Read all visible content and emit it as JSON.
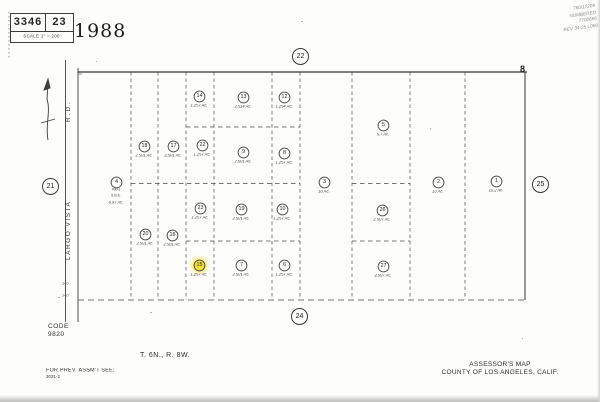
{
  "header": {
    "book": "3346",
    "page": "23",
    "scale_label": "SCALE 1\" =  200'",
    "year": "1988",
    "handwritten_notes": [
      "760/17209",
      "NUMBERED",
      "7702666",
      "REV 34-25 L068"
    ],
    "corner_point": "8"
  },
  "road": {
    "suffix": "R.D.",
    "name": "LARGO  VISTA",
    "width_label": "30",
    "station_labels": [
      "140",
      "140"
    ]
  },
  "boundary_circles": [
    {
      "label": "21",
      "x": 50,
      "y": 186
    },
    {
      "label": "22",
      "x": 300,
      "y": 56
    },
    {
      "label": "24",
      "x": 299,
      "y": 316
    },
    {
      "label": "25",
      "x": 540,
      "y": 184
    }
  ],
  "parcels": [
    {
      "num": "14",
      "acreage": "1.257 Ac.",
      "x": 199,
      "y": 96
    },
    {
      "num": "13",
      "acreage": "2.514 Ac.",
      "x": 243,
      "y": 97
    },
    {
      "num": "12",
      "acreage": "1.254 Ac.",
      "x": 284,
      "y": 97
    },
    {
      "num": "5",
      "acreage": "5.7 Ac.",
      "x": 383,
      "y": 125
    },
    {
      "num": "18",
      "acreage": "2.501 Ac.",
      "x": 144,
      "y": 146
    },
    {
      "num": "17",
      "acreage": "2.501 Ac.",
      "x": 173,
      "y": 146
    },
    {
      "num": "22",
      "acreage": "1.257 Ac.",
      "x": 202,
      "y": 145
    },
    {
      "num": "9",
      "acreage": "2.501 Ac.",
      "x": 243,
      "y": 152
    },
    {
      "num": "8",
      "acreage": "1.257 Ac.",
      "x": 284,
      "y": 153
    },
    {
      "num": "4",
      "acreage": "8.97 Ac.",
      "x": 116,
      "y": 182,
      "notes": [
        "400'±",
        "S.B.E."
      ]
    },
    {
      "num": "3",
      "acreage": "10 Ac.",
      "x": 324,
      "y": 182
    },
    {
      "num": "2",
      "acreage": "10 Ac.",
      "x": 438,
      "y": 182
    },
    {
      "num": "1",
      "acreage": "10.2 Ac.",
      "x": 496,
      "y": 181
    },
    {
      "num": "23",
      "acreage": "1.257 Ac.",
      "x": 200,
      "y": 208
    },
    {
      "num": "19",
      "acreage": "2.501 Ac.",
      "x": 241,
      "y": 209
    },
    {
      "num": "10",
      "acreage": "1.257 Ac.",
      "x": 282,
      "y": 209
    },
    {
      "num": "26",
      "acreage": "2.507 Ac.",
      "x": 382,
      "y": 210
    },
    {
      "num": "20",
      "acreage": "2.501 Ac.",
      "x": 145,
      "y": 234
    },
    {
      "num": "16",
      "acreage": "2.501 Ac.",
      "x": 172,
      "y": 235
    },
    {
      "num": "15",
      "acreage": "1.257 Ac.",
      "x": 199,
      "y": 265,
      "highlight": true
    },
    {
      "num": "7",
      "acreage": "2.501 Ac.",
      "x": 241,
      "y": 265
    },
    {
      "num": "6",
      "acreage": "1.257 Ac.",
      "x": 284,
      "y": 265
    },
    {
      "num": "27",
      "acreage": "2.507 Ac.",
      "x": 383,
      "y": 266
    }
  ],
  "footer": {
    "code_label": "CODE",
    "code_value": "9820",
    "township": "T. 6N., R. 8W.",
    "prev_label": "FOR PREV. ASSM'T SEE:",
    "prev_value": "3031-2",
    "map_title": "ASSESSOR'S MAP",
    "map_subtitle": "COUNTY OF LOS ANGELES, CALIF."
  }
}
